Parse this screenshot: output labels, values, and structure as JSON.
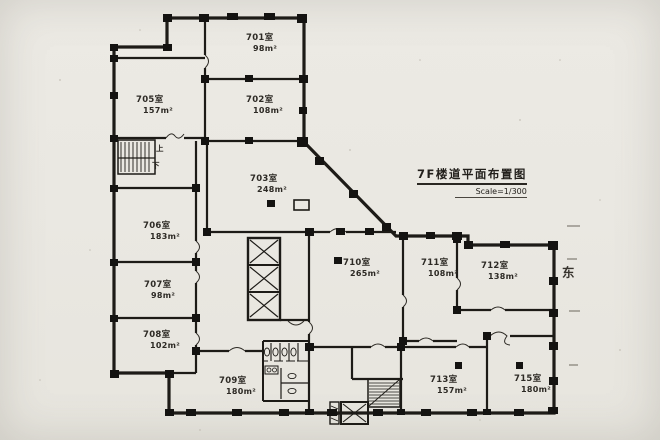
{
  "drawing": {
    "title": "7F楼道平面布置图",
    "scale": "Scale=1/300",
    "orientation_east": "东",
    "stair_up": "上",
    "stair_down": "下",
    "wall_color": "#1d1b17",
    "paper_color": "#eae8e2"
  },
  "rooms": [
    {
      "number": "701室",
      "area": "98m²"
    },
    {
      "number": "702室",
      "area": "108m²"
    },
    {
      "number": "703室",
      "area": "248m²"
    },
    {
      "number": "705室",
      "area": "157m²"
    },
    {
      "number": "706室",
      "area": "183m²"
    },
    {
      "number": "707室",
      "area": "98m²"
    },
    {
      "number": "708室",
      "area": "102m²"
    },
    {
      "number": "709室",
      "area": "180m²"
    },
    {
      "number": "710室",
      "area": "265m²"
    },
    {
      "number": "711室",
      "area": "108m²"
    },
    {
      "number": "712室",
      "area": "138m²"
    },
    {
      "number": "713室",
      "area": "157m²"
    },
    {
      "number": "715室",
      "area": "180m²"
    }
  ]
}
